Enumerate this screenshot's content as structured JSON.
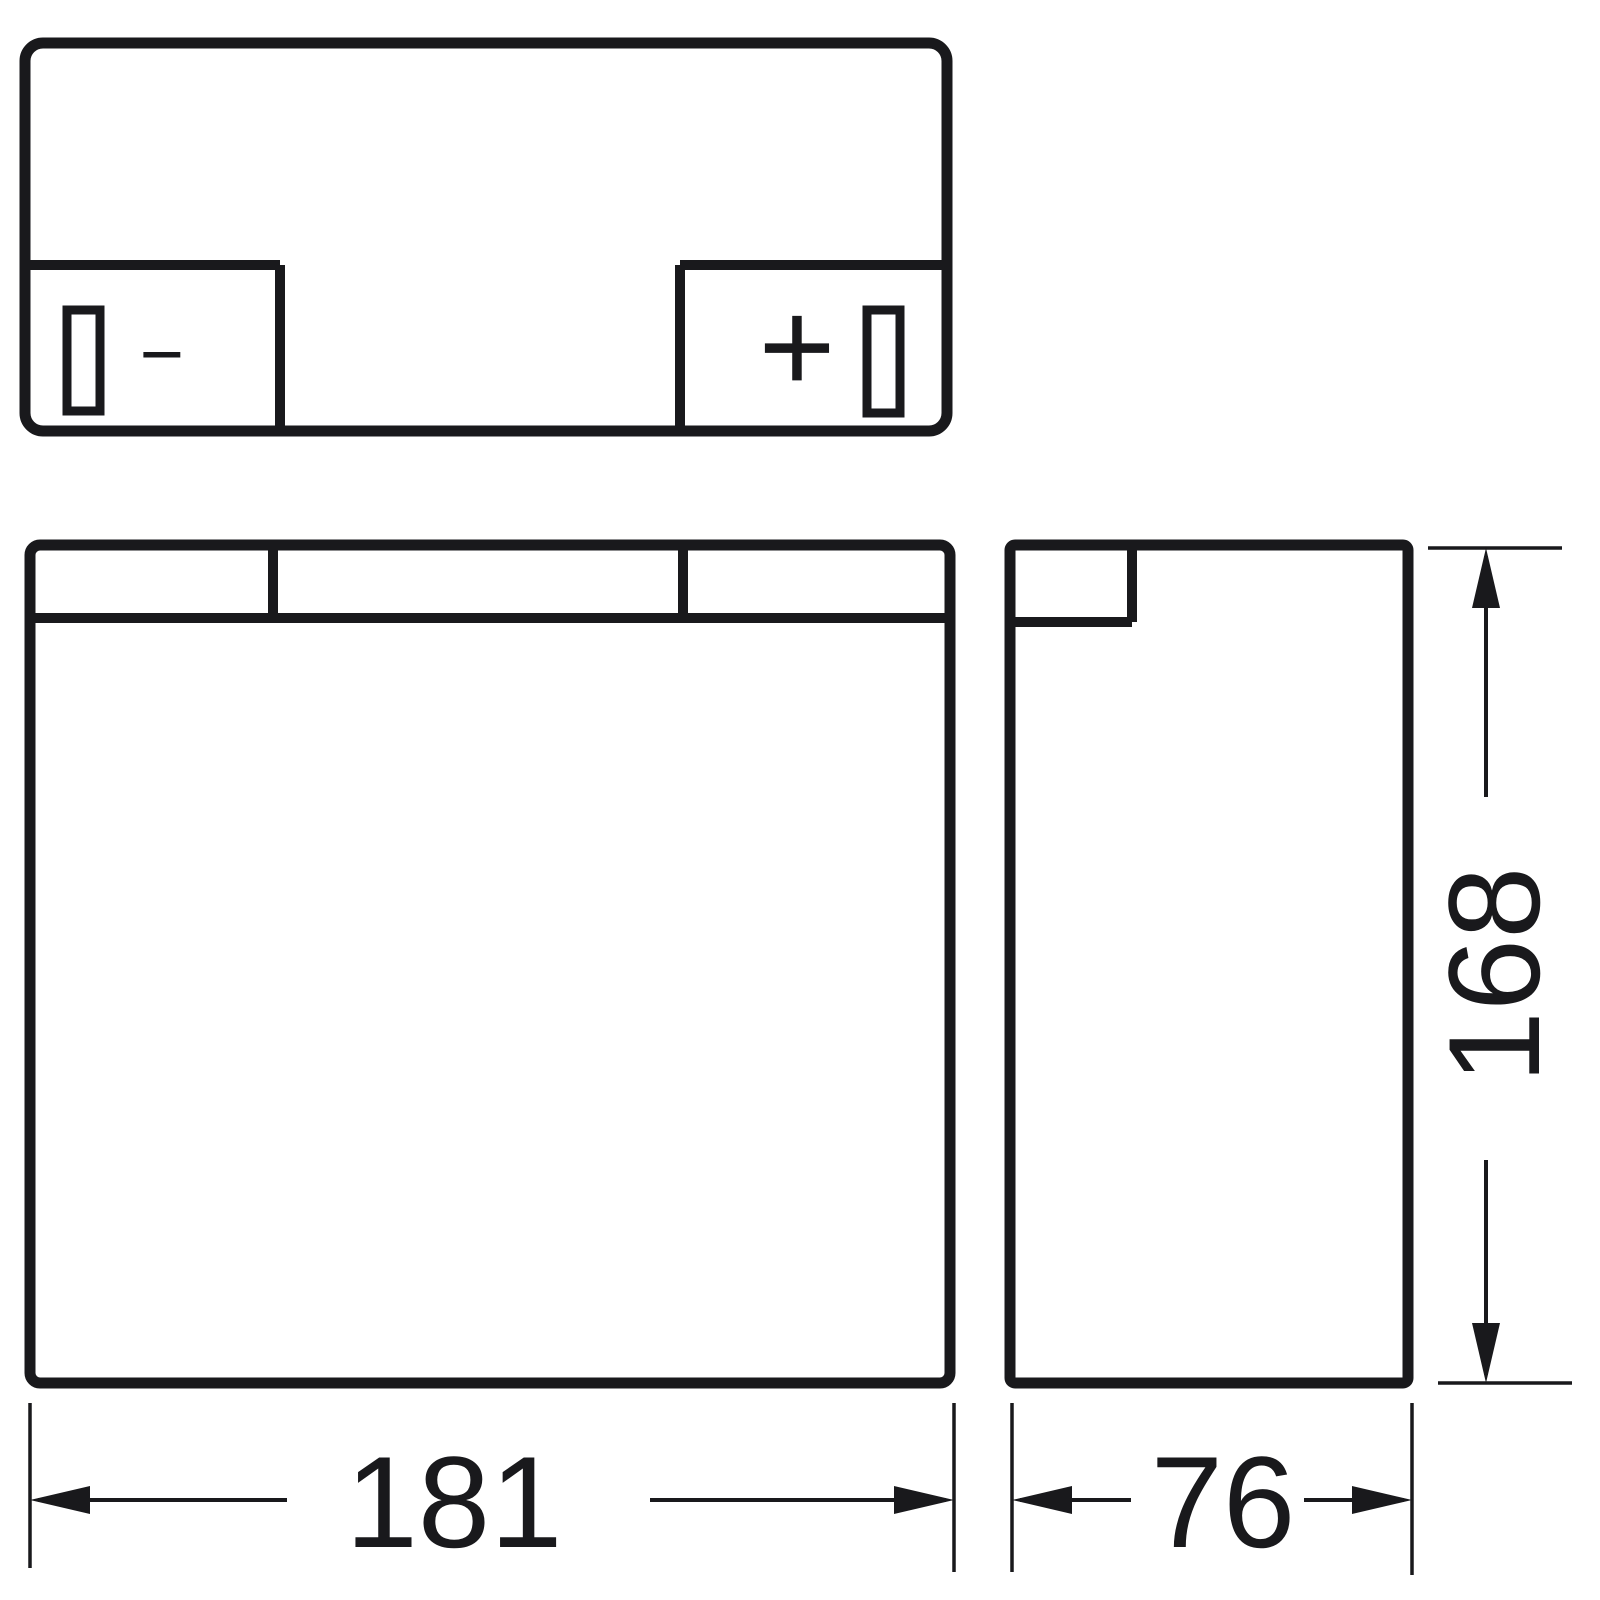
{
  "drawing": {
    "description": "Battery outline dimension drawing with top view, front view and side view",
    "colors": {
      "background": "#ffffff",
      "line": "#19191c"
    },
    "terminals": {
      "negative": "−",
      "positive": "+"
    },
    "dimensions": {
      "length_mm": "181",
      "depth_mm": "76",
      "height_mm": "168"
    }
  }
}
